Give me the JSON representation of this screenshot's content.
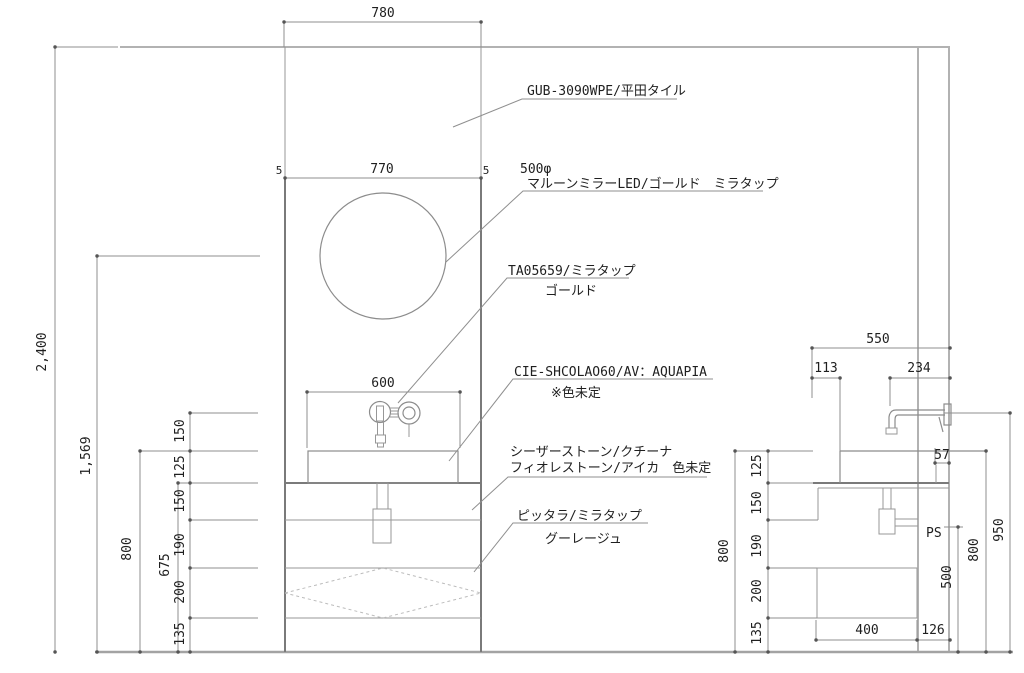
{
  "labels": {
    "tile": {
      "line1": "GUB-3090WPE/平田タイル"
    },
    "mirror": {
      "dia": "500φ",
      "line1": "マルーンミラーLED/ゴールド　ミラタップ"
    },
    "faucet": {
      "line1": "TA05659/ミラタップ",
      "line2": "ゴールド"
    },
    "basin": {
      "line1": "CIE-SHCOLAO60/AV：AQUAPIA",
      "line2": "※色未定"
    },
    "counter": {
      "line1": "シーザーストーン/クチーナ",
      "line2": "フィオレストーン/アイカ　色未定"
    },
    "lower_panel": {
      "line1": "ピッタラ/ミラタップ",
      "line2": "グーレージュ"
    },
    "ps": "PS"
  },
  "dims": {
    "elevation": {
      "panel_width": "780",
      "mirror_panel": "770",
      "edge_left": "5",
      "edge_right": "5",
      "basin_width": "600",
      "wall_height": "2,400",
      "mirror_center_height": "1,569",
      "rim_height": "800",
      "counter_height": "675",
      "stack": [
        "150",
        "125",
        "150",
        "190",
        "200",
        "135"
      ]
    },
    "section": {
      "depth": "550",
      "offset": "113",
      "spout": "234",
      "spout_wall": "57",
      "stack": [
        "125",
        "150",
        "190",
        "200",
        "135"
      ],
      "left_height": "800",
      "trap_height": "500",
      "rim_height": "800",
      "spout_height": "950",
      "cabinet_depth": "400",
      "wall_gap": "126"
    }
  }
}
